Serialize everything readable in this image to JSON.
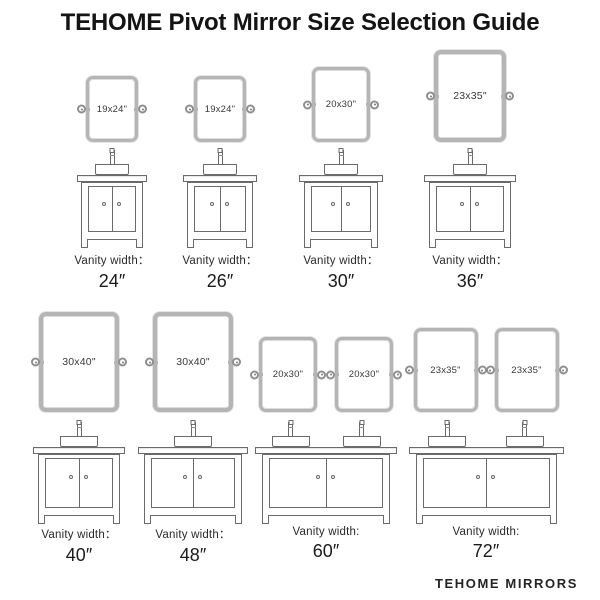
{
  "title": "TEHOME Pivot Mirror Size Selection Guide",
  "footer": "TEHOME MIRRORS",
  "colors": {
    "background": "#ffffff",
    "mirror_frame": "#b5b5b5",
    "line_art": "#6a6a6a",
    "text": "#141414"
  },
  "units": [
    {
      "mirrors": [
        "19x24\""
      ],
      "label": "Vanity width：",
      "width": "24″"
    },
    {
      "mirrors": [
        "19x24\""
      ],
      "label": "Vanity width：",
      "width": "26″"
    },
    {
      "mirrors": [
        "20x30\""
      ],
      "label": "Vanity width：",
      "width": "30″"
    },
    {
      "mirrors": [
        "23x35\""
      ],
      "label": "Vanity width：",
      "width": "36″"
    },
    {
      "mirrors": [
        "30x40\""
      ],
      "label": "Vanity width：",
      "width": "40″"
    },
    {
      "mirrors": [
        "30x40\""
      ],
      "label": "Vanity width：",
      "width": "48″"
    },
    {
      "mirrors": [
        "20x30\"",
        "20x30\""
      ],
      "label": "Vanity width:",
      "width": "60″"
    },
    {
      "mirrors": [
        "23x35\"",
        "23x35\""
      ],
      "label": "Vanity width:",
      "width": "72″"
    }
  ]
}
